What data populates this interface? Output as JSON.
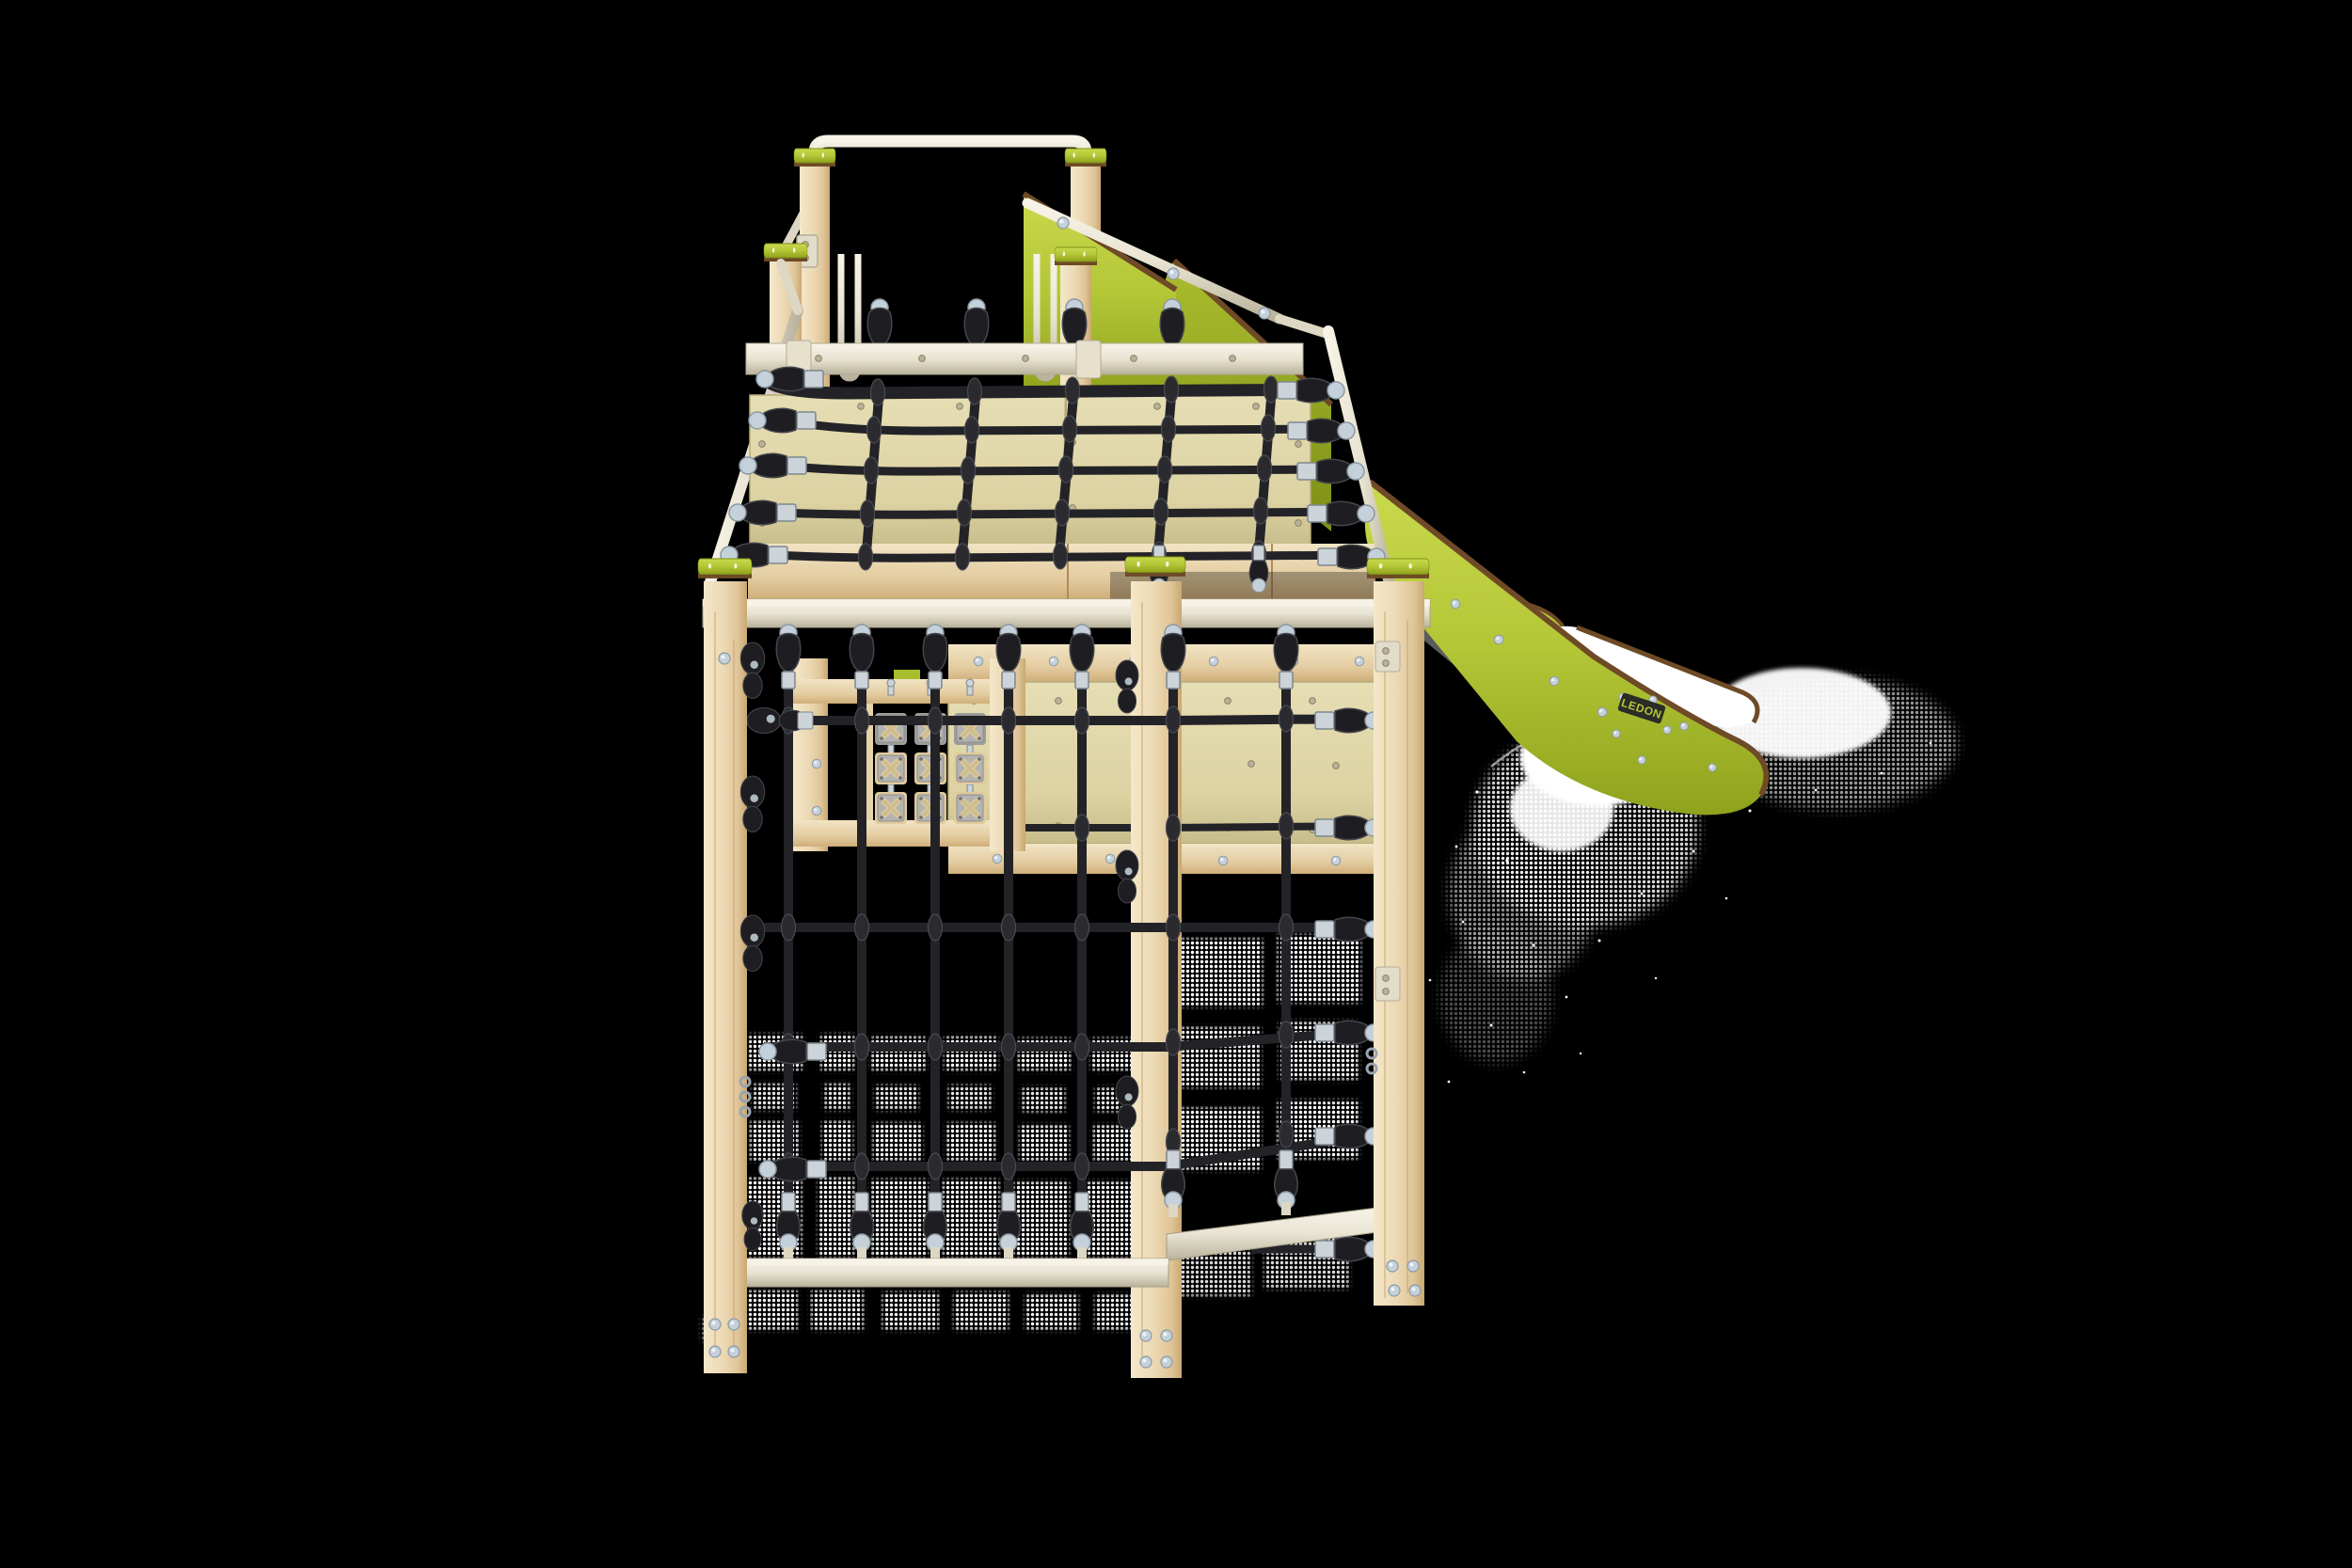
{
  "image_type": "3d-product-render",
  "subject": "wooden playground climbing tower with rope nets, tic-tac-toe panel and slide",
  "background_color": "#000000",
  "brand_badge": {
    "text": "LEDON",
    "background": "#2b2b27",
    "text_color": "#b9cc3a"
  },
  "palette": {
    "background": "#000000",
    "wood": "#ecd9b4",
    "wood_light": "#f4e7c9",
    "wood_dark": "#d8bd8e",
    "wood_deep": "#c09d69",
    "cream": "#e9e4d2",
    "cream_light": "#f6f2e6",
    "cream_dark": "#c6c0ab",
    "lime": "#b3c636",
    "lime_light": "#c9da4d",
    "lime_dark": "#9aad20",
    "lime_deep": "#84961a",
    "trim_brown": "#6e4a26",
    "beige": "#ded5a6",
    "beige_dark": "#ccc290",
    "rope": "#232327",
    "rope_light": "#3d3d44",
    "silver": "#ccd3d9",
    "silver_dark": "#97a1aa",
    "ball": "#c5d1da",
    "tile_grey": "#a9a9a7",
    "tile_wood": "#e0cb9e",
    "x_beige": "#d9c79a",
    "underside_grey": "#707274",
    "white": "#ffffff"
  },
  "parts": [
    "rear-guardrail",
    "guard-posts",
    "post-caps",
    "hand-loops",
    "slide-entry-panels",
    "platform-wall-panels",
    "platform-climbing-net",
    "rope-tensioners",
    "deck-rail",
    "lower-cage-posts",
    "lower-climbing-net",
    "tic-tac-toe-panel",
    "back-wall-panel",
    "bottom-rails",
    "slide",
    "slide-bed",
    "ground-shadows"
  ]
}
